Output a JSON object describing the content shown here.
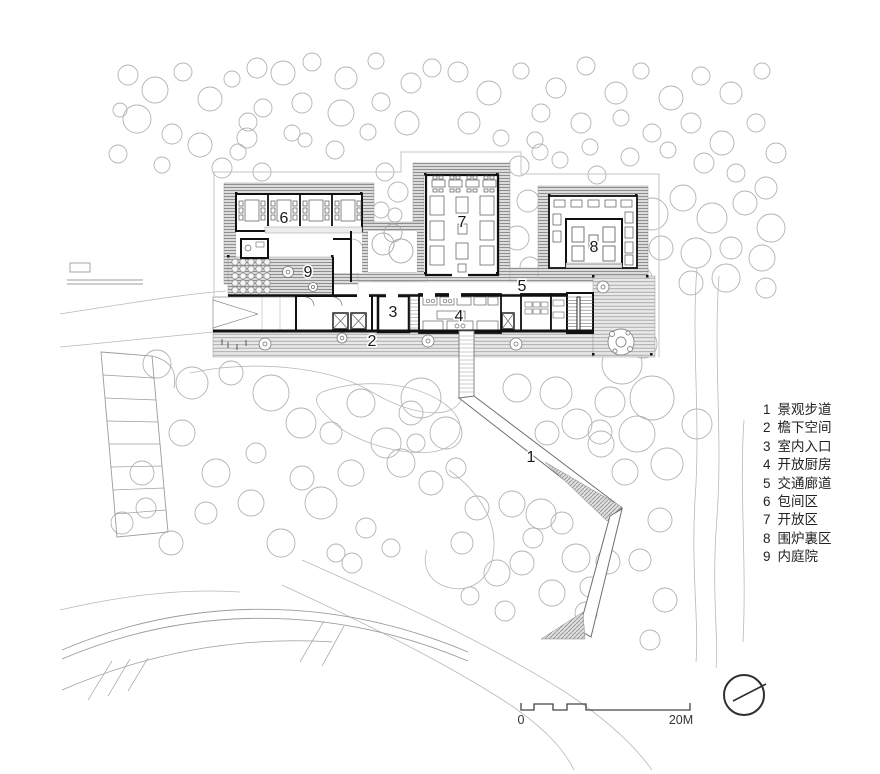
{
  "rooms": [
    {
      "num": "1",
      "name": "景观步道"
    },
    {
      "num": "2",
      "name": "檐下空间"
    },
    {
      "num": "3",
      "name": "室内入口"
    },
    {
      "num": "4",
      "name": "开放厨房"
    },
    {
      "num": "5",
      "name": "交通廊道"
    },
    {
      "num": "6",
      "name": "包间区"
    },
    {
      "num": "7",
      "name": "开放区"
    },
    {
      "num": "8",
      "name": "围炉裏区"
    },
    {
      "num": "9",
      "name": "内庭院"
    }
  ],
  "scale_bar": {
    "start": "0",
    "end": "20M"
  },
  "colors": {
    "wall": "#1a1a1a",
    "eave_hatch": "#8f8f8f",
    "deck_hatch": "#a0a0a0",
    "tree_line": "#b3b3b3",
    "text": "#222222"
  }
}
